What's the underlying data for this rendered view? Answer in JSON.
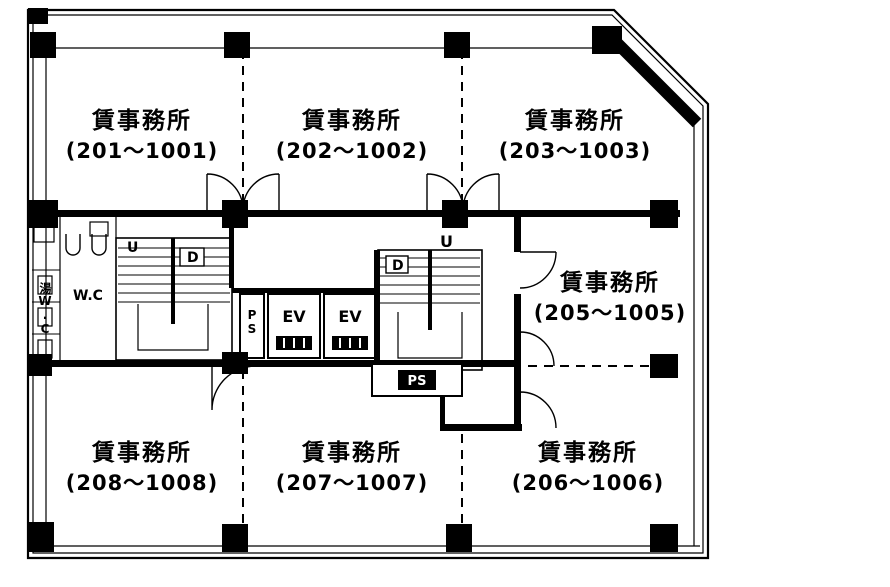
{
  "rooms": [
    {
      "name": "賃事務所",
      "units": "(201〜1001)"
    },
    {
      "name": "賃事務所",
      "units": "(202〜1002)"
    },
    {
      "name": "賃事務所",
      "units": "(203〜1003)"
    },
    {
      "name": "賃事務所",
      "units": "(205〜1005)"
    },
    {
      "name": "賃事務所",
      "units": "(208〜1008)"
    },
    {
      "name": "賃事務所",
      "units": "(207〜1007)"
    },
    {
      "name": "賃事務所",
      "units": "(206〜1006)"
    }
  ],
  "core": {
    "wc": "W.C",
    "ev": "EV",
    "ps_duct": "PS",
    "ps_shaft": "PS",
    "up": "U",
    "down": "D",
    "service": "湯W.C"
  },
  "colors": {
    "ink": "#000000",
    "paper": "#ffffff"
  }
}
